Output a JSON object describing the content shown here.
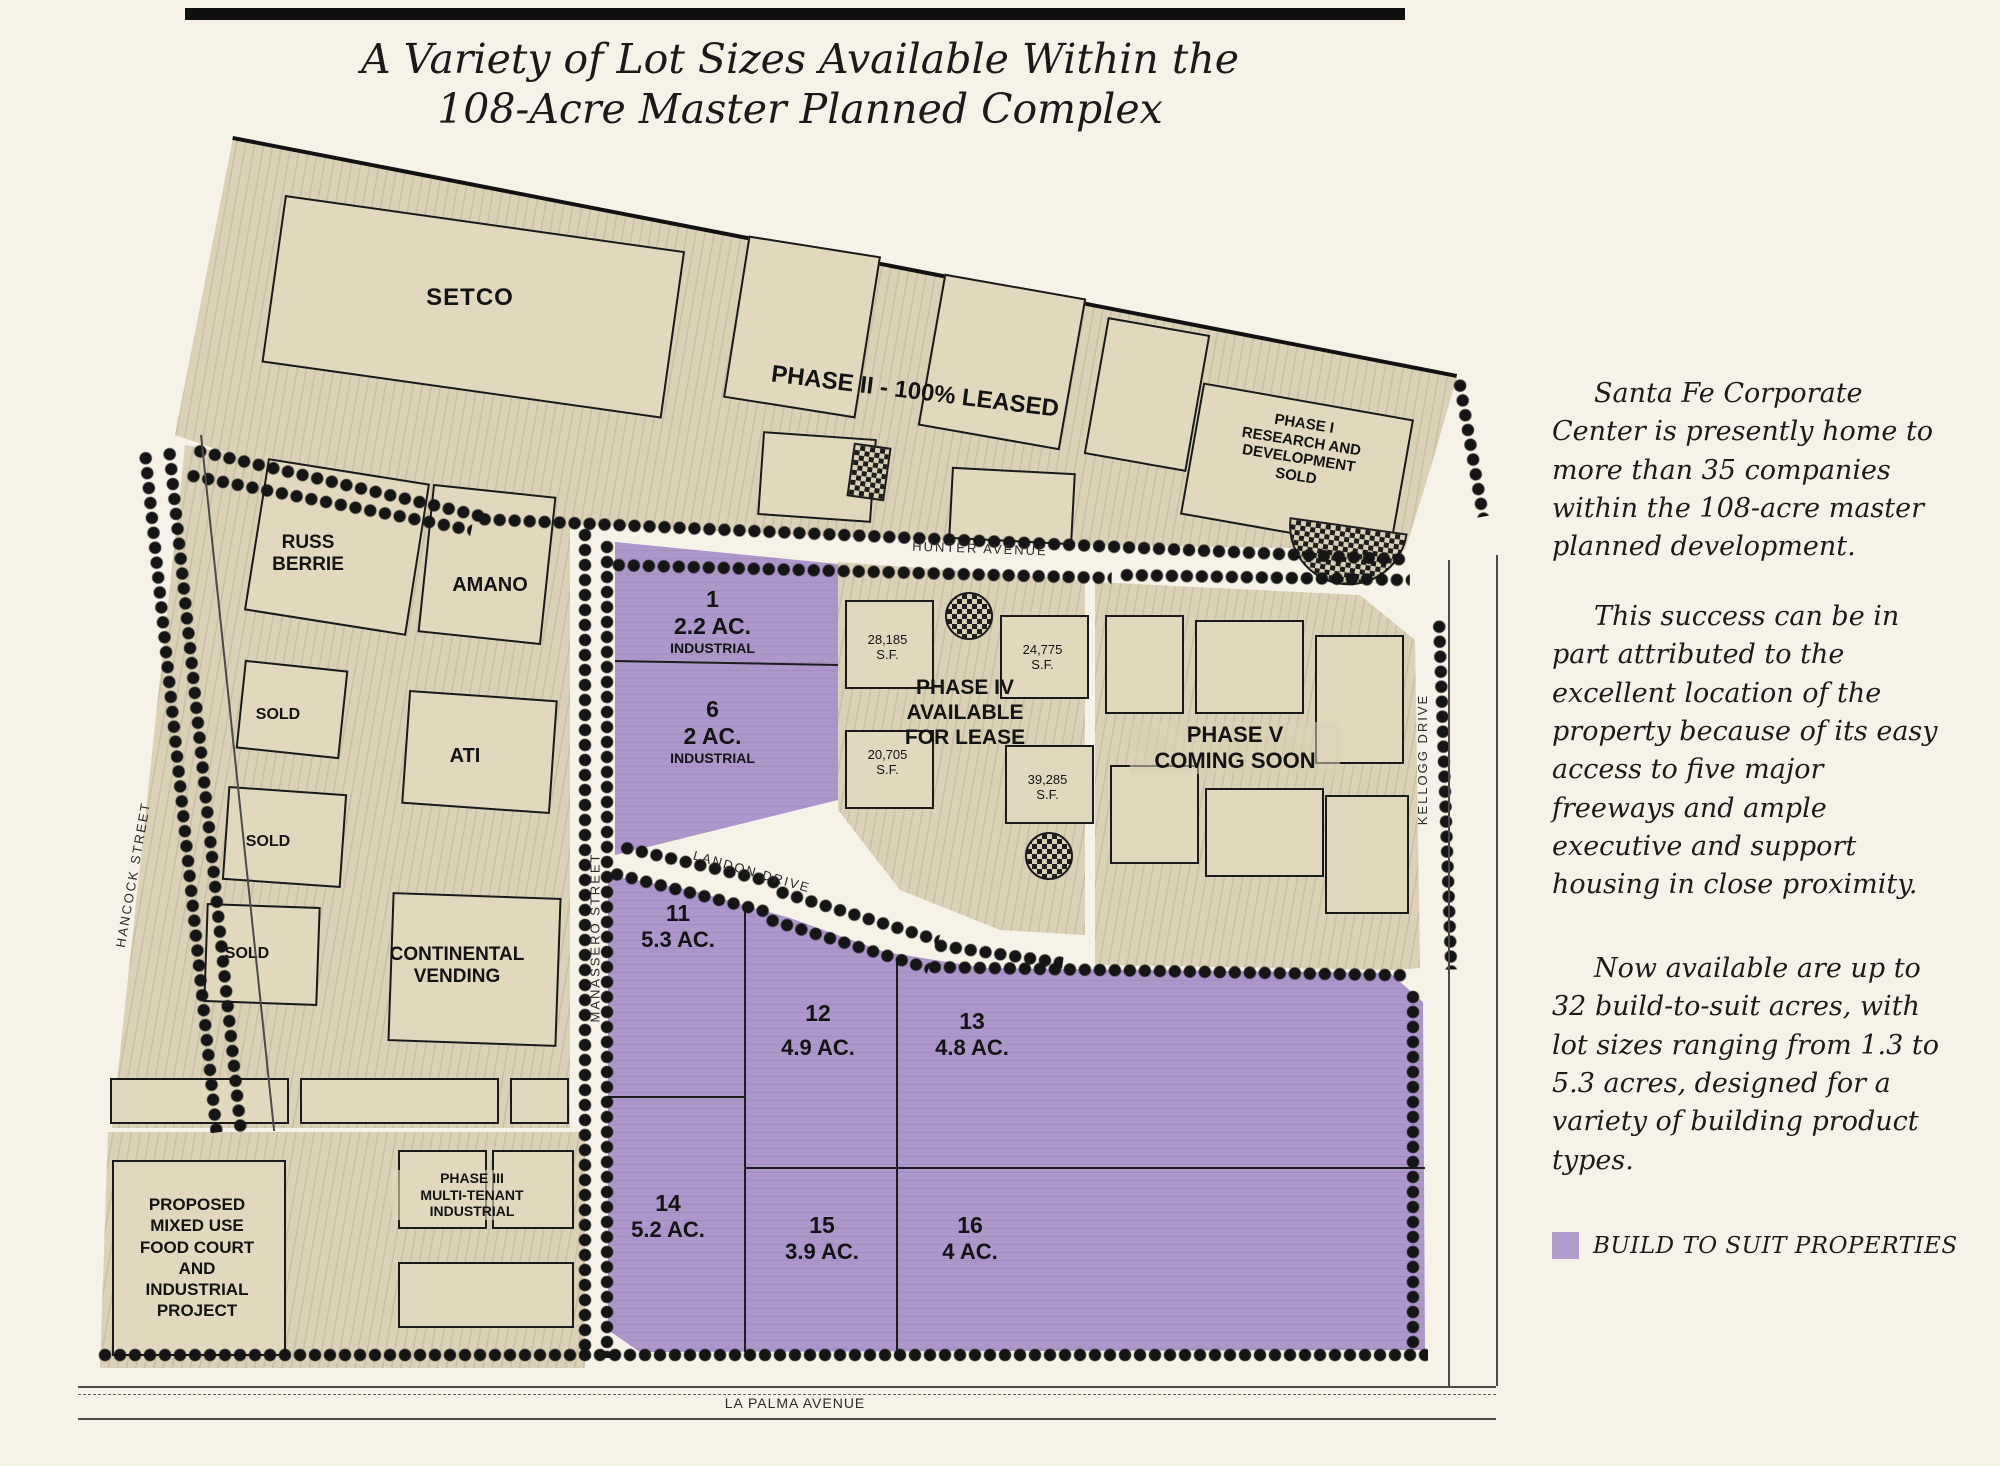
{
  "page": {
    "title_line1": "A Variety of Lot Sizes Available Within the",
    "title_line2": "108-Acre Master Planned Complex"
  },
  "sidebar": {
    "paragraphs": [
      "Santa Fe Corporate Center is presently home to more than 35 companies within the 108-acre master planned development.",
      "This success can be in part attributed to the excellent location of the property because of its easy access to five major freeways and ample executive and support housing in close proximity.",
      "Now available are up to 32 build-to-suit acres, with lot sizes ranging from 1.3 to 5.3 acres, designed for a variety of building product types."
    ],
    "legend": {
      "swatch_color": "#b29bce",
      "label": "BUILD TO SUIT PROPERTIES"
    }
  },
  "map": {
    "streets": {
      "hunter": "HUNTER AVENUE",
      "hancock": "HANCOCK STREET",
      "manassero": "MANASSERO STREET",
      "landon": "LANDON DRIVE",
      "kellogg": "KELLOGG DRIVE",
      "la_palma": "LA PALMA AVENUE"
    },
    "north": {
      "setco": "SETCO",
      "phase2": "PHASE II - 100% LEASED",
      "phase1_lines": [
        "PHASE I",
        "RESEARCH AND",
        "DEVELOPMENT",
        "SOLD"
      ]
    },
    "west": {
      "russ_berrie_lines": [
        "RUSS",
        "BERRIE"
      ],
      "amano": "AMANO",
      "sold_a": "SOLD",
      "ati": "ATI",
      "sold_b": "SOLD",
      "sold_c": "SOLD",
      "continental_lines": [
        "CONTINENTAL",
        "VENDING"
      ]
    },
    "southwest": {
      "proposed_lines": [
        "PROPOSED",
        "MIXED USE",
        "FOOD COURT",
        "AND",
        "INDUSTRIAL",
        "PROJECT"
      ],
      "phase3_lines": [
        "PHASE III",
        "MULTI-TENANT",
        "INDUSTRIAL"
      ]
    },
    "phase4": {
      "title_lines": [
        "PHASE IV",
        "AVAILABLE",
        "FOR LEASE"
      ],
      "buildings": [
        {
          "sf": "28,185",
          "unit": "S.F."
        },
        {
          "sf": "24,775",
          "unit": "S.F."
        },
        {
          "sf": "20,705",
          "unit": "S.F."
        },
        {
          "sf": "39,285",
          "unit": "S.F."
        }
      ]
    },
    "phase5_lines": [
      "PHASE V",
      "COMING SOON"
    ],
    "lots": [
      {
        "num": "1",
        "size": "2.2 AC.",
        "type": "INDUSTRIAL"
      },
      {
        "num": "6",
        "size": "2 AC.",
        "type": "INDUSTRIAL"
      },
      {
        "num": "11",
        "size": "5.3 AC."
      },
      {
        "num": "12",
        "size": "4.9 AC."
      },
      {
        "num": "13",
        "size": "4.8 AC."
      },
      {
        "num": "14",
        "size": "5.2 AC."
      },
      {
        "num": "15",
        "size": "3.9 AC."
      },
      {
        "num": "16",
        "size": "4 AC."
      }
    ],
    "colors": {
      "build_to_suit": "#ad96ca",
      "parcel_tan": "#dbd1b6"
    }
  }
}
